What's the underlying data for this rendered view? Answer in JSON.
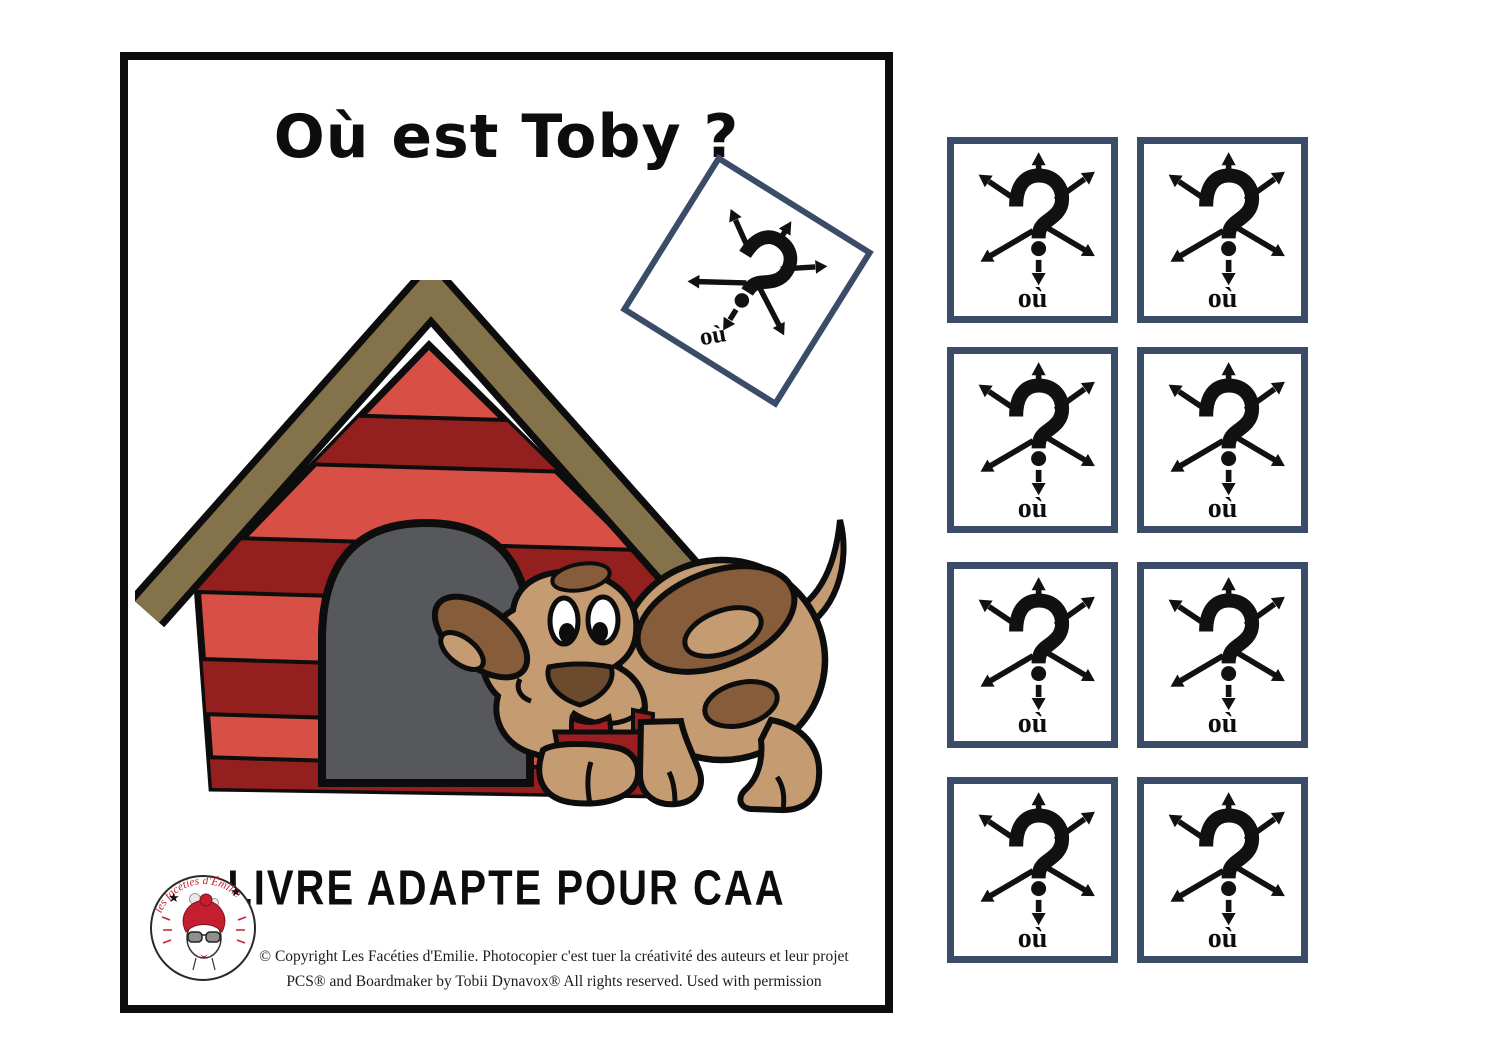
{
  "page": {
    "title": "Où est Toby ?",
    "subtitle": "LIVRE ADAPTE POUR CAA",
    "copyright_line1": "© Copyright Les Facéties d'Emilie. Photocopier c'est tuer la créativité des auteurs et leur projet",
    "copyright_line2": "PCS® and Boardmaker by Tobii Dynavox® All rights reserved. Used with permission",
    "logo": {
      "arc_text": "les facéties d'Émilie"
    }
  },
  "card": {
    "label": "où"
  },
  "cards_count": 8,
  "illustration": {
    "description_items": [
      "red doghouse with brown roof",
      "gray arched door",
      "brown puppy Toby"
    ]
  },
  "colors": {
    "card_border": "#3a4c67",
    "page_border": "#0d0d0d",
    "house_red_light": "#d85045",
    "house_red_dark": "#931f1e",
    "roof_brown": "#84734a",
    "door_gray": "#56585c",
    "dog_light": "#c59b72",
    "dog_dark": "#875c3b",
    "tongue_red": "#a82025",
    "collar_red": "#9b1e22",
    "logo_red": "#c41f2e"
  }
}
